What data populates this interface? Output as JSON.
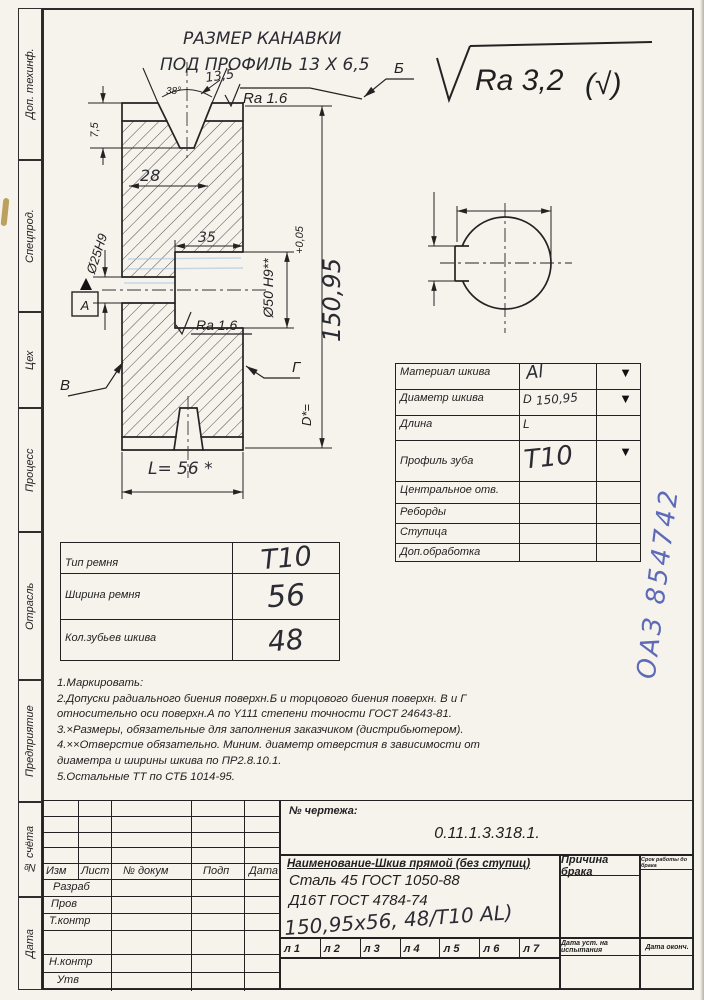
{
  "margin_labels": [
    "Доп. техинф.",
    "Спецпрод.",
    "Цех",
    "Процесс",
    "Отрасль",
    "Предприятие",
    "№ счёта",
    "Дата"
  ],
  "annotations": {
    "groove_note_line1": "РАЗМЕР КАНАВКИ",
    "groove_note_line2": "ПОД ПРОФИЛЬ 13 Х 6,5",
    "general_roughness": "Ra 3,2",
    "general_roughness_alt": "(√)",
    "roughness_top": "Ra 1.6",
    "roughness_bore": "Ra 1.6",
    "datum": "А",
    "surface_b": "Б",
    "surface_v": "В",
    "surface_g": "Г"
  },
  "dimensions": {
    "angle": "38°",
    "groove_top_width": "13,5",
    "dim_28": "28",
    "rim_depth": "7,5",
    "counterbore_depth": "35",
    "bore": "Ø25Н9",
    "counterbore": "Ø50 Н9**",
    "tolerance": "+0,05",
    "outer_dia_prefix": "D*=",
    "outer_dia_value": "150,95",
    "length": "L= 56 *"
  },
  "params_table": {
    "rows": [
      {
        "label": "Материал шкива",
        "prefix": "",
        "value": "Al",
        "arrow": "▼"
      },
      {
        "label": "Диаметр шкива",
        "prefix": "D",
        "value": "150,95",
        "arrow": "▼"
      },
      {
        "label": "Длина",
        "prefix": "L",
        "value": "",
        "arrow": ""
      },
      {
        "label": "Профиль зуба",
        "prefix": "",
        "value": "Т10",
        "arrow": "▼"
      },
      {
        "label": "Центральное отв.",
        "prefix": "",
        "value": "",
        "arrow": ""
      },
      {
        "label": "Реборды",
        "prefix": "",
        "value": "",
        "arrow": ""
      },
      {
        "label": "Ступица",
        "prefix": "",
        "value": "",
        "arrow": ""
      },
      {
        "label": "Доп.обработка",
        "prefix": "",
        "value": "",
        "arrow": ""
      }
    ]
  },
  "belt_table": {
    "rows": [
      {
        "label": "Тип ремня",
        "value": "Т10"
      },
      {
        "label": "Ширина ремня",
        "value": "56"
      },
      {
        "label": "Кол.зубьев шкива",
        "value": "48"
      }
    ]
  },
  "notes": {
    "lines": [
      "1.Маркировать:",
      "2.Допуски радиального биения поверхн.Б и торцового биения поверхн. В и Г",
      "относительно оси поверхн.А по Y111 степени точности ГОСТ 24643-81.",
      "3.×Размеры, обязательные для заполнения заказчиком (дистрибьютером).",
      "4.××Отверстие обязательно. Миним. диаметр отверстия в зависимости от",
      "диаметра и ширины шкива по ПР2.8.10.1.",
      "5.Остальные ТТ по СТБ 1014-95."
    ]
  },
  "stamp": {
    "text": "ОАЗ 854742"
  },
  "title_block": {
    "drawing_no_label": "№ чертежа:",
    "drawing_no": "0.11.1.3.318.1.",
    "name": "Наименование-Шкив прямой (без ступиц)",
    "material_1": "Сталь 45 ГОСТ 1050-88",
    "material_2": "Д16Т ГОСТ 4784-74",
    "handwritten_spec": "150,95х56, 48/Т10 AL)",
    "defect_label": "Причина брака",
    "service_label": "Срок работы до брака",
    "date_test_label": "Дата уст. на испытания",
    "date_end_label": "Дата оконч.",
    "sheet_labels": [
      "л 1",
      "л 2",
      "л 3",
      "л 4",
      "л 5",
      "л 6",
      "л 7"
    ],
    "rev_headers": [
      "Изм",
      "Лист",
      "№ докум",
      "Подп",
      "Дата"
    ],
    "sign_rows": [
      "Разраб",
      "Пров",
      "Т.контр",
      "",
      "Н.контр",
      "Утв"
    ]
  }
}
